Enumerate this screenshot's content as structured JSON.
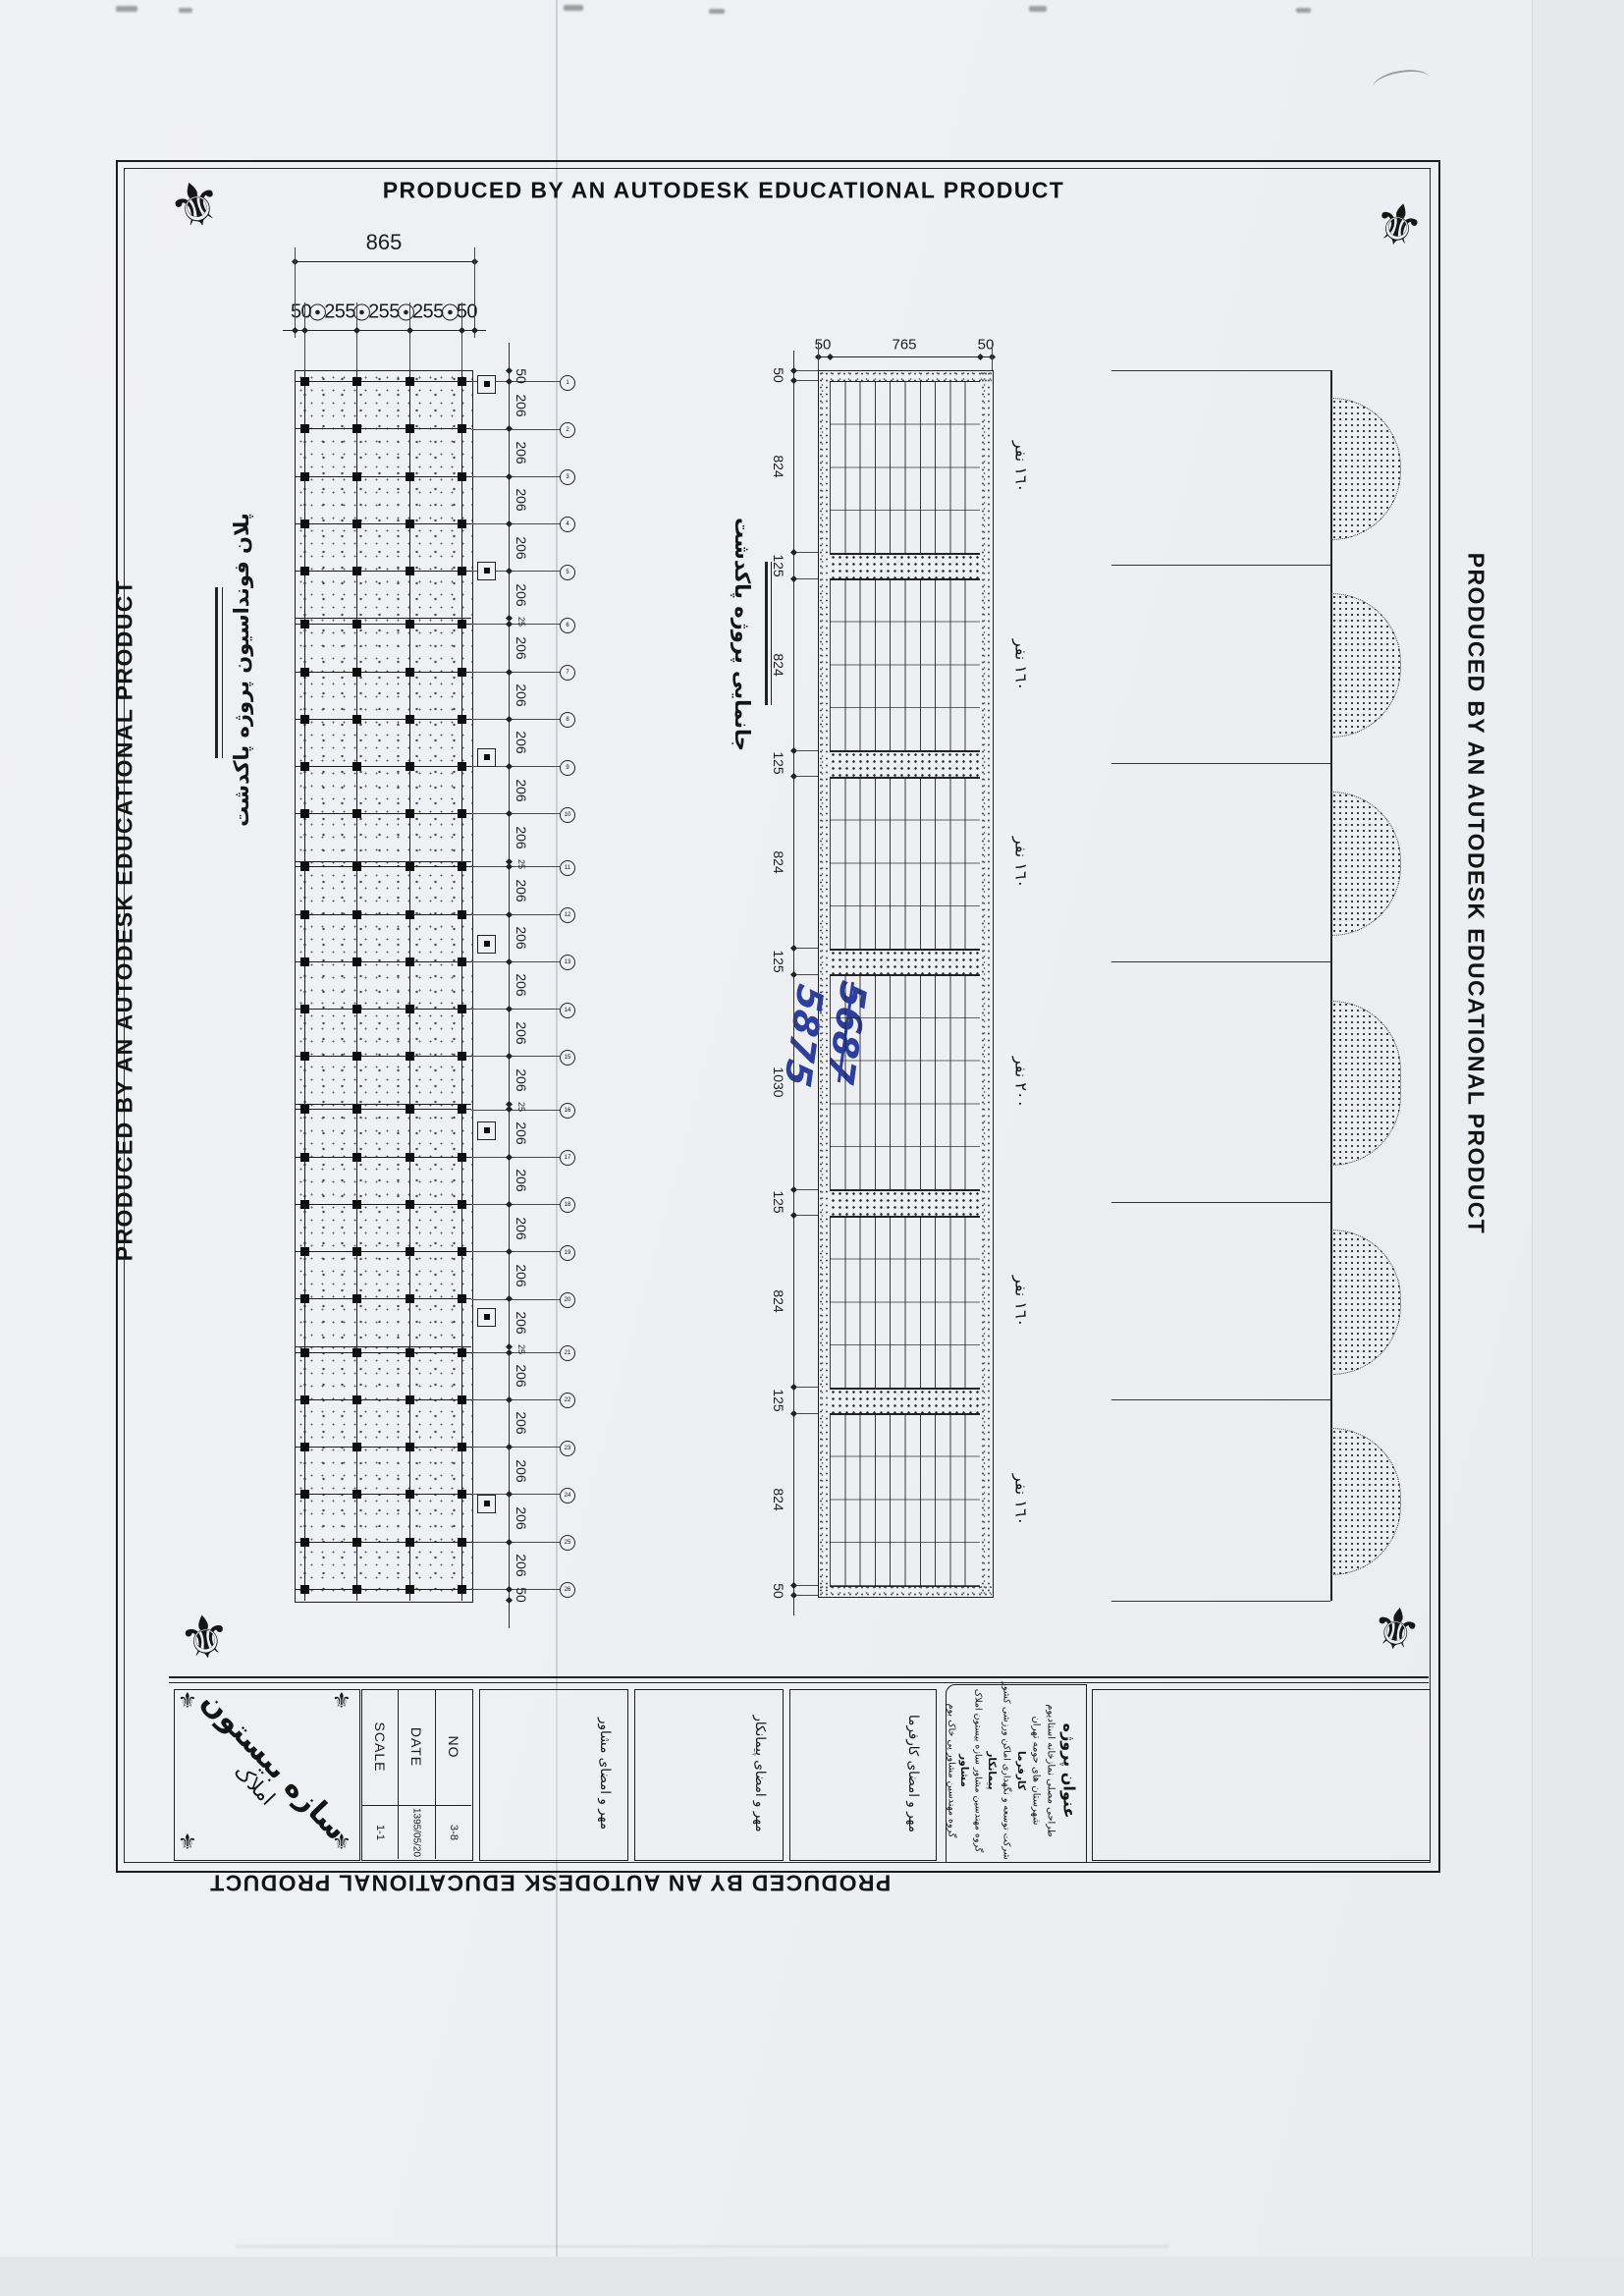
{
  "produced_by": "PRODUCED BY AN AUTODESK EDUCATIONAL PRODUCT",
  "foundation_plan": {
    "title": "پلان فونداسیون پروژه پاکدشت",
    "total_width_dim": "865",
    "top_chain": [
      "50",
      "255",
      "255",
      "255",
      "50"
    ],
    "right_chain": [
      "50",
      "206",
      "206",
      "206",
      "206",
      "206",
      "25",
      "206",
      "206",
      "206",
      "206",
      "206",
      "25",
      "206",
      "206",
      "206",
      "206",
      "206",
      "25",
      "206",
      "206",
      "206",
      "206",
      "206",
      "25",
      "206",
      "206",
      "206",
      "206",
      "206",
      "50"
    ],
    "grid_columns": 4,
    "row_bubbles": 26
  },
  "site_layout": {
    "title": "جانمایی پروژه پاکدشت",
    "top_dims": [
      "50",
      "765",
      "50"
    ],
    "left_chain": [
      "50",
      "824",
      "125",
      "824",
      "125",
      "824",
      "125",
      "1030",
      "125",
      "824",
      "125",
      "824",
      "50"
    ],
    "blocks": [
      {
        "depth": "824",
        "capacity": "١٦٠ نفر"
      },
      {
        "depth": "824",
        "capacity": "١٦٠ نفر"
      },
      {
        "depth": "824",
        "capacity": "١٦٠ نفر"
      },
      {
        "depth": "1030",
        "capacity": "٢٠٠ نفر"
      },
      {
        "depth": "824",
        "capacity": "١٦٠ نفر"
      },
      {
        "depth": "824",
        "capacity": "١٦٠ نفر"
      }
    ]
  },
  "arch_elevation": {
    "bays": 6
  },
  "handwriting": {
    "first": "5687",
    "second": "5875",
    "ink_color": "#2c3f9e"
  },
  "title_block": {
    "stamp": {
      "line1": "سازه بیستون",
      "line2": "املاک"
    },
    "fields": [
      {
        "label": "NO",
        "value": "3-8"
      },
      {
        "label": "DATE",
        "value": "1395/05/20"
      },
      {
        "label": "SCALE",
        "value": "1-1"
      }
    ],
    "signatures": [
      "مهر و امضای مشاور",
      "مهر و امضای پیمانکار",
      "مهر و امضای کارفرما"
    ],
    "project": {
      "heading": "عنوان پروژه",
      "lines": [
        "طراحی مصلی نمازخانه استادیوم",
        "شهرستان های حومه تهران",
        "کارفرما",
        "شرکت توسعه و نگهداری اماکن ورزشی کشور",
        "پیمانکار",
        "گروه مهندسین مشاور سازه بیستون املاک",
        "مشاور",
        "گروه مهندسین مشاور پی خاک بوم"
      ]
    }
  }
}
